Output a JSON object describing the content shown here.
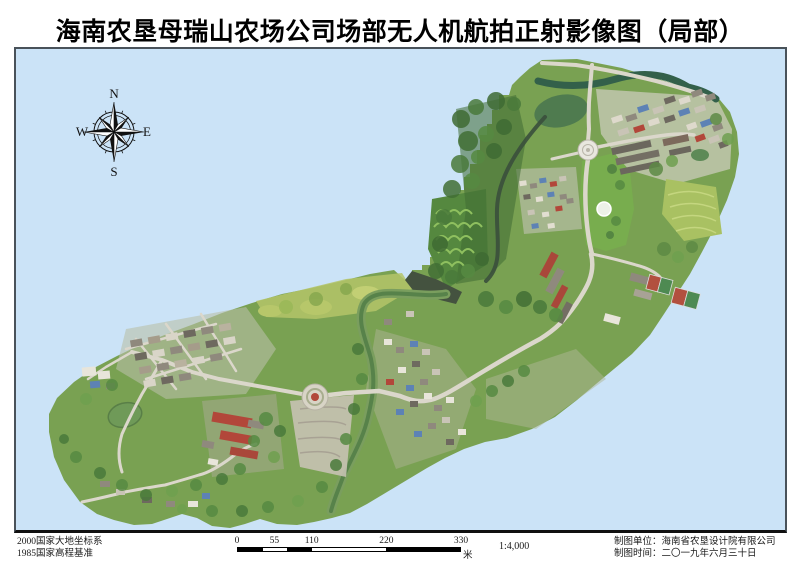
{
  "title": "海南农垦母瑞山农场公司场部无人机航拍正射影像图（局部）",
  "compass": {
    "north": "N",
    "south": "S",
    "east": "E",
    "west": "W"
  },
  "map": {
    "background_color": "#cbe3f7",
    "frame_color": "#49525a"
  },
  "footer": {
    "datum_lines": [
      "2000国家大地坐标系",
      "1985国家高程基准"
    ],
    "scalebar": {
      "tick_labels": [
        "0",
        "55",
        "110",
        "220",
        "330"
      ],
      "unit": "米",
      "scale_ratio": "1:4,000"
    },
    "credits": [
      "制图单位：海南省农垦设计院有限公司",
      "制图时间：二〇一九年六月三十日"
    ]
  },
  "colors": {
    "page": "#ffffff",
    "map_background": "#cbe3f7",
    "scalebar_fill": "#000000"
  }
}
